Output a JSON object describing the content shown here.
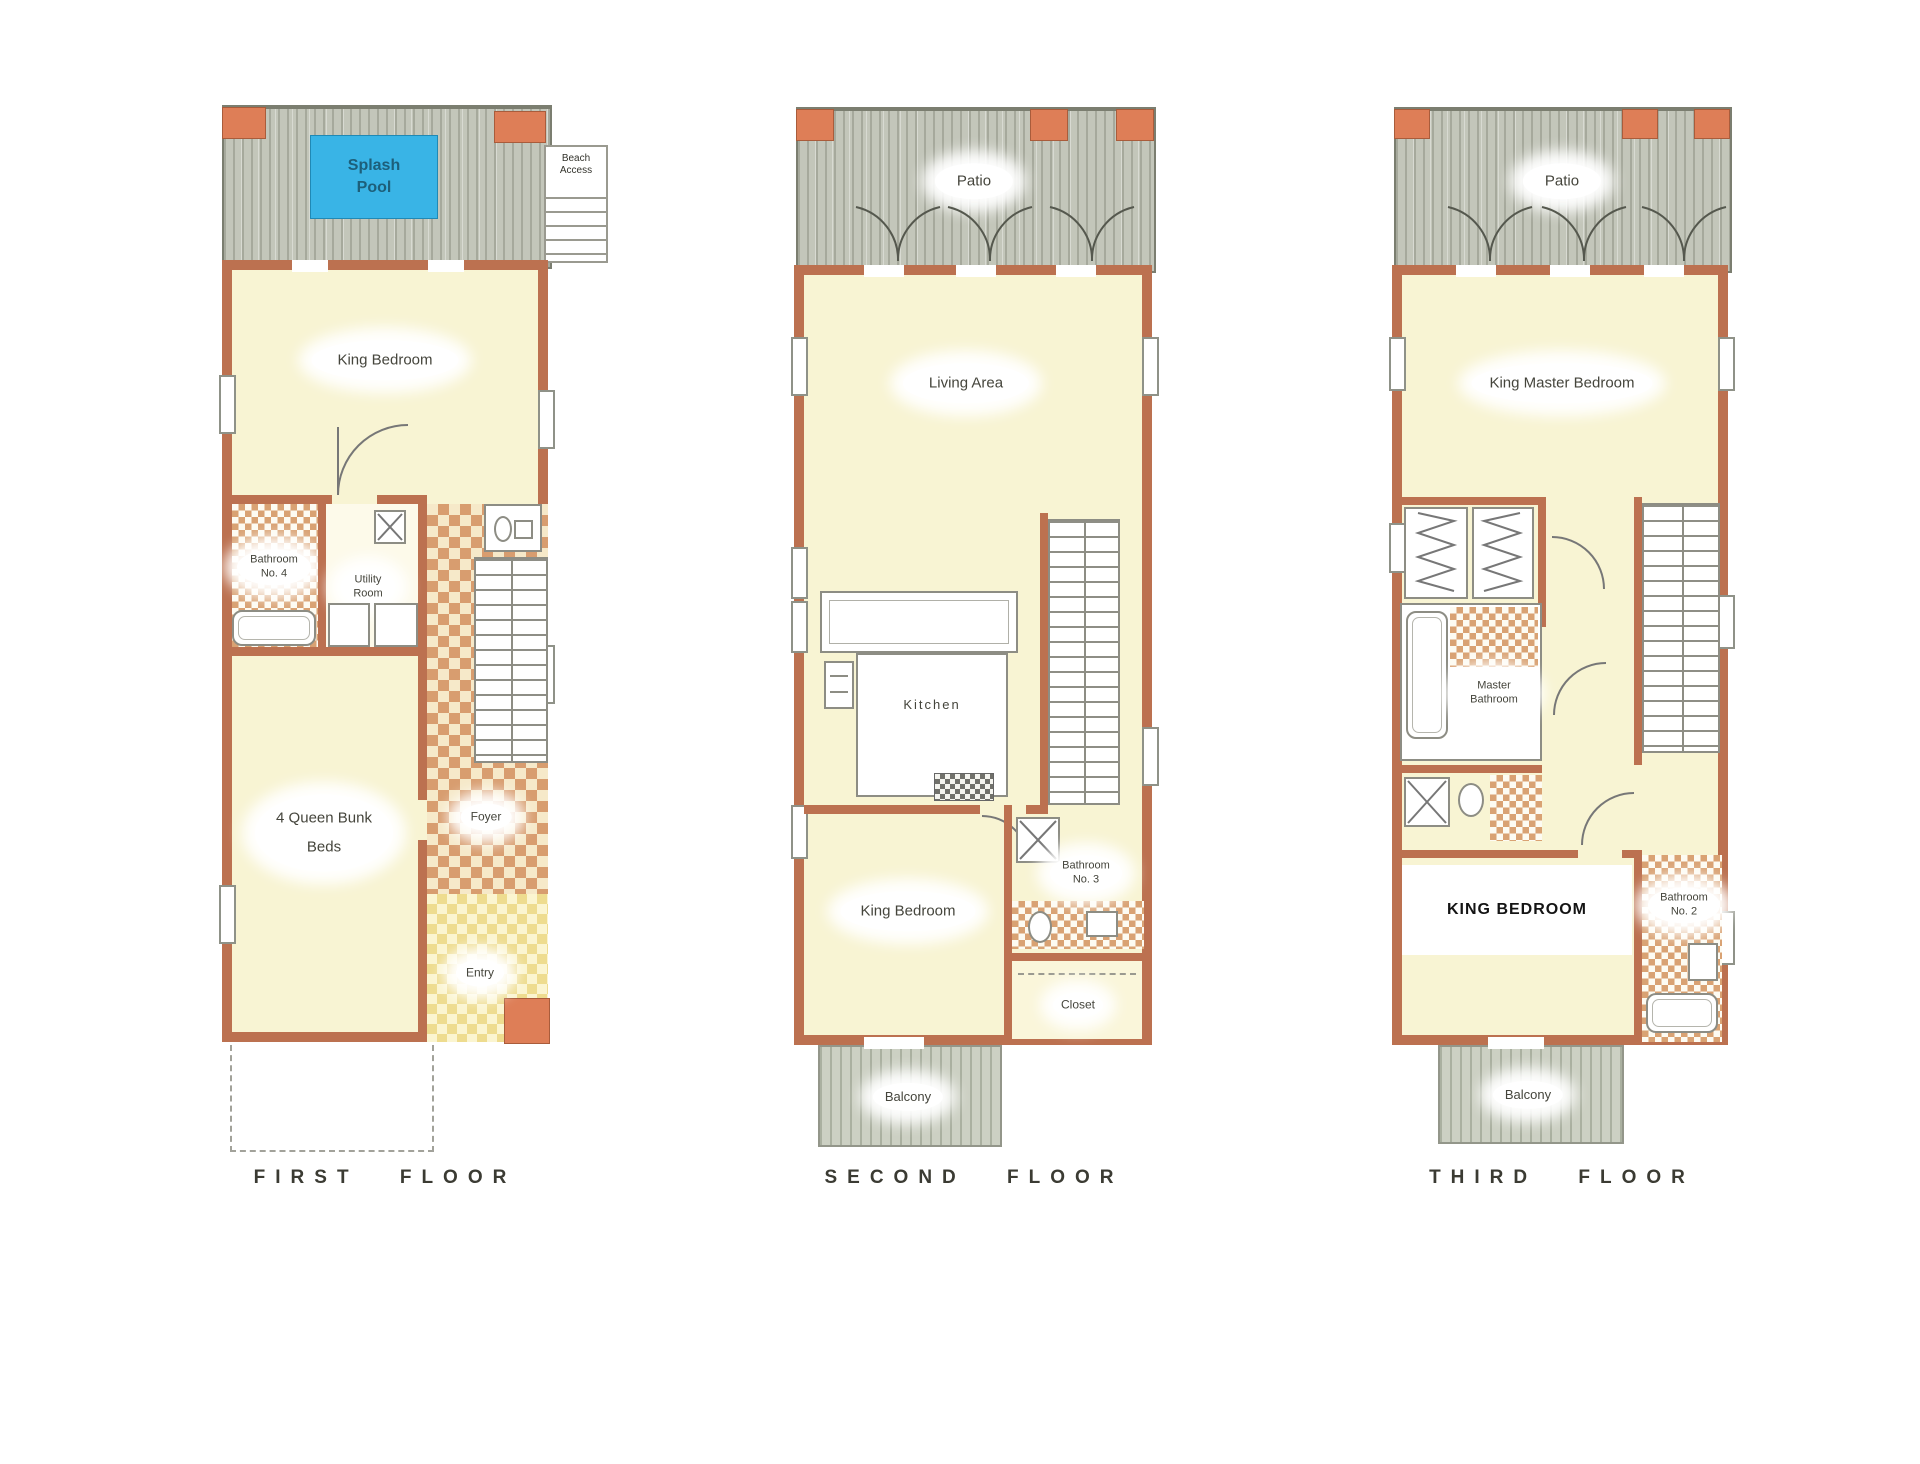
{
  "document_type": "vacation-home floor plan diagram, three stacked-lot floors shown side by side",
  "colors": {
    "wall": "#bc7150",
    "wall_block": "#de7e57",
    "room_fill": "#f8f4d3",
    "deck": "#c3c6ba",
    "splash_pool": "#39b4e6",
    "tile_orange": "#d89d6f",
    "tile_yellow": "#eedc8f",
    "label_text": "#45453c",
    "title_text": "#3b3b33"
  },
  "floors": {
    "first": {
      "title": "FIRST FLOOR",
      "splash_pool": "Splash Pool",
      "beach_access": "Beach Access",
      "king_bedroom": "King Bedroom",
      "bathroom4": "Bathroom No. 4",
      "utility": "Utility Room",
      "bunk_room": "4 Queen Bunk Beds",
      "foyer": "Foyer",
      "entry": "Entry"
    },
    "second": {
      "title": "SECOND FLOOR",
      "patio": "Patio",
      "living": "Living Area",
      "kitchen": "Kitchen",
      "king_bedroom": "King Bedroom",
      "bathroom3": "Bathroom No. 3",
      "closet": "Closet",
      "balcony": "Balcony"
    },
    "third": {
      "title": "THIRD FLOOR",
      "patio": "Patio",
      "master_bedroom": "King Master Bedroom",
      "master_bathroom": "Master Bathroom",
      "king_bedroom": "KING BEDROOM",
      "bathroom2": "Bathroom No. 2",
      "balcony": "Balcony"
    }
  }
}
